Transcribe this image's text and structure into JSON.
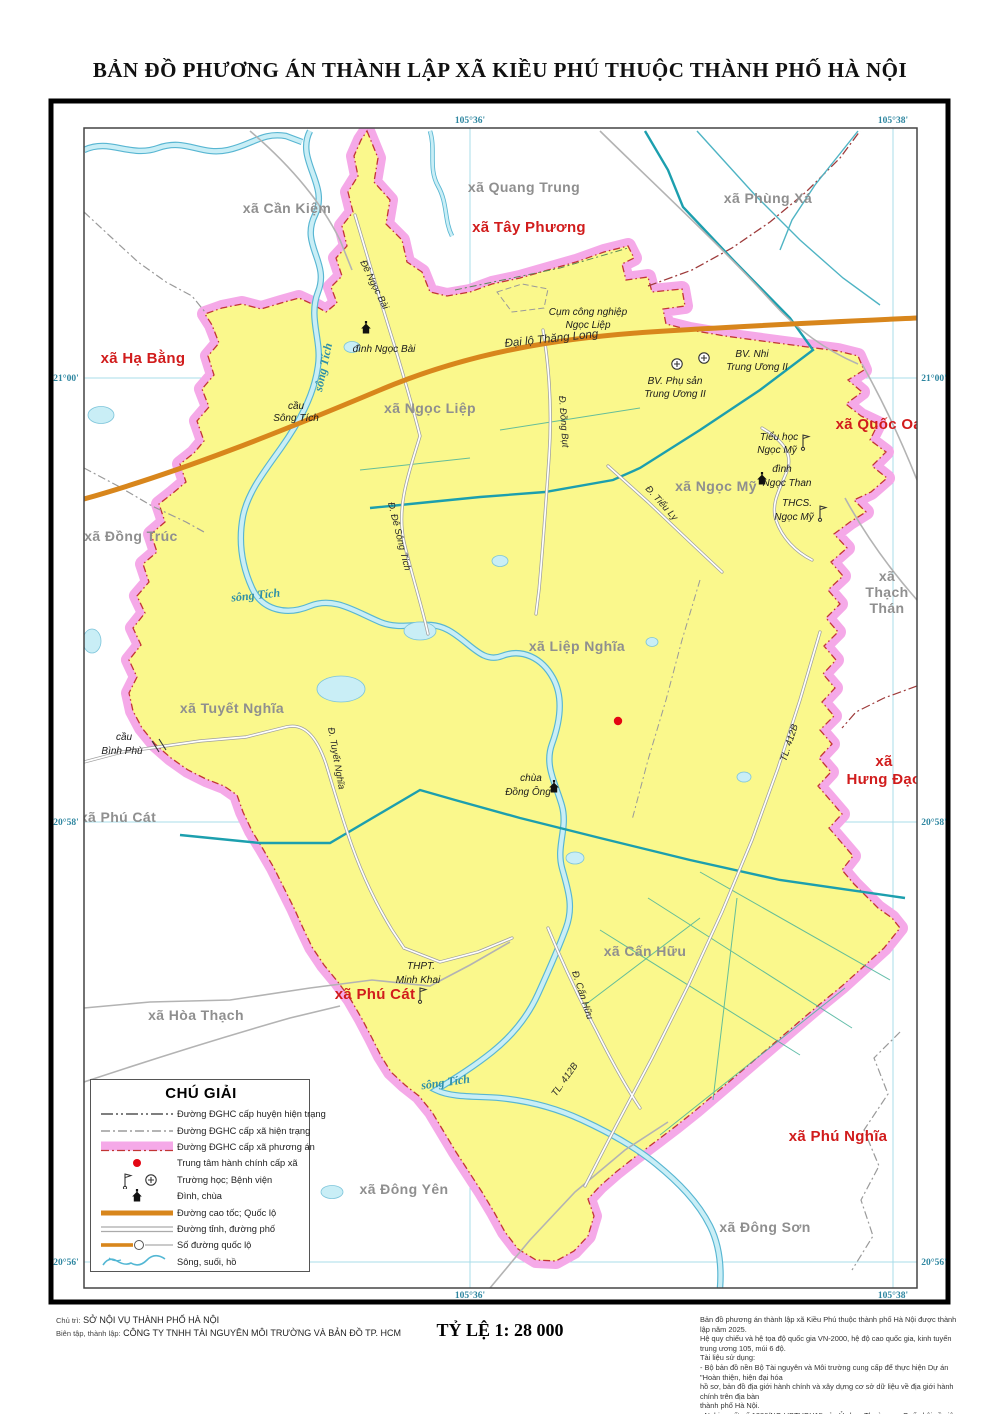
{
  "title": "BẢN ĐỒ PHƯƠNG ÁN THÀNH LẬP XÃ KIỀU PHÚ THUỘC THÀNH PHỐ HÀ NỘI",
  "colors": {
    "commune_fill": "#FAF88C",
    "boundary_band": "#F5A9E8",
    "boundary_line": "#C23535",
    "highway": "#D8861C",
    "river": "#C9EEF6",
    "admin_center_dot": "#E30613",
    "adjacent_label": "#D11C1C",
    "current_label": "#8F8F8F"
  },
  "coords": {
    "top": [
      "105°36'",
      "105°38'"
    ],
    "bottom": [
      "105°36'",
      "105°38'"
    ],
    "left": [
      "21°00'",
      "20°58'",
      "20°56'"
    ],
    "right": [
      "21°00'",
      "20°58'",
      "20°56'"
    ]
  },
  "communes_current": [
    "xã Cần Kiệm",
    "xã Quang Trung",
    "xã Phùng Xá",
    "xã Ngọc Liệp",
    "xã Đồng Trúc",
    "xã Ngọc Mỹ",
    "xã Liệp Nghĩa",
    "xã Tuyết Nghĩa",
    "xã Phú Cát",
    "xã Hòa Thạch",
    "xã Đông Yên",
    "xã Đông Sơn",
    "xã Cấn Hữu"
  ],
  "thach_than": [
    "xã",
    "Thạch",
    "Thán"
  ],
  "communes_adjacent": [
    "xã Hạ Bằng",
    "xã Tây Phương",
    "xã Quốc Oai",
    "xã Phú Cát",
    "xã Phú Nghĩa"
  ],
  "hung_dao": [
    "xã",
    "Hưng Đạo"
  ],
  "river_label": "sông Tích",
  "roads": {
    "de_ngoc_bai": "Đê Ngọc Bài",
    "dai_lo_thang_long": "Đại lộ Thăng Long",
    "dong_but": "Đ. Đồng Bụt",
    "de_song_tich": "Đ. Đê Sông Tích",
    "tieu_ly": "Đ. Tiểu Ly",
    "tuyet_nghia": "Đ. Tuyết Nghĩa",
    "tl412b": "TL. 412B",
    "can_huu": "Đ. Cấn Hữu"
  },
  "pois": {
    "dinh_ngoc_bai": "đình Ngọc Bài",
    "cau_song_tich": [
      "cầu",
      "Sông Tích"
    ],
    "cum_cn": [
      "Cụm công nghiệp",
      "Ngọc Liệp"
    ],
    "bv_nhi": [
      "BV. Nhi",
      "Trung Ương II"
    ],
    "bv_phu_san": [
      "BV. Phụ sản",
      "Trung Ương II"
    ],
    "tieu_hoc": [
      "Tiểu học",
      "Ngọc Mỹ"
    ],
    "dinh_ngoc_than": [
      "đình",
      "Ngọc Than"
    ],
    "thcs": [
      "THCS.",
      "Ngọc Mỹ"
    ],
    "chua_dong_ong": [
      "chùa",
      "Đồng Ông"
    ],
    "cau_binh_phu": [
      "cầu",
      "Bình Phù"
    ],
    "thpt": [
      "THPT.",
      "Minh Khai"
    ]
  },
  "legend": {
    "title": "CHÚ GIẢI",
    "items": [
      "Đường ĐGHC cấp huyện hiện trạng",
      "Đường ĐGHC cấp xã hiện trạng",
      "Đường ĐGHC cấp xã phương án",
      "Trung tâm hành chính cấp xã",
      "Trường học; Bệnh viện",
      "Đình, chùa",
      "Đường cao tốc; Quốc lộ",
      "Đường tỉnh, đường phố",
      "Số đường quốc lộ",
      "Sông, suối, hồ"
    ]
  },
  "footer": {
    "chu_tri_label": "Chủ trì:",
    "chu_tri": "SỞ NỘI VỤ THÀNH PHỐ HÀ NỘI",
    "bien_tap_label": "Biên tập, thành lập:",
    "bien_tap": "CÔNG TY TNHH TÀI NGUYÊN MÔI TRƯỜNG VÀ BẢN ĐỒ TP. HCM",
    "scale": "TỶ LỆ 1: 28 000",
    "notes": [
      "Bản đồ phương án thành lập xã Kiều Phú thuộc thành phố Hà Nội được thành lập năm 2025.",
      "Hệ quy chiếu và hệ tọa độ quốc gia VN-2000, hệ độ cao quốc gia, kinh tuyến trung ương 105, múi 6 độ.",
      "Tài liệu sử dụng:",
      "- Bộ bản đồ nền Bộ Tài nguyên và Môi trường cung cấp để thực hiện Dự án \"Hoàn thiện, hiện đại hóa",
      "hồ sơ, bản đồ địa giới hành chính và xây dựng cơ sở dữ liệu về địa giới hành chính trên địa bàn",
      "thành phố Hà Nội.",
      "- Nghị quyết số 1286/NQ-UBTVQH15 của Ủy ban Thường vụ Quốc hội về việc sắp xếp đơn vị",
      "hành chính cấp xã của thành phố Hà Nội giai đoạn 2023 - 2025."
    ]
  }
}
